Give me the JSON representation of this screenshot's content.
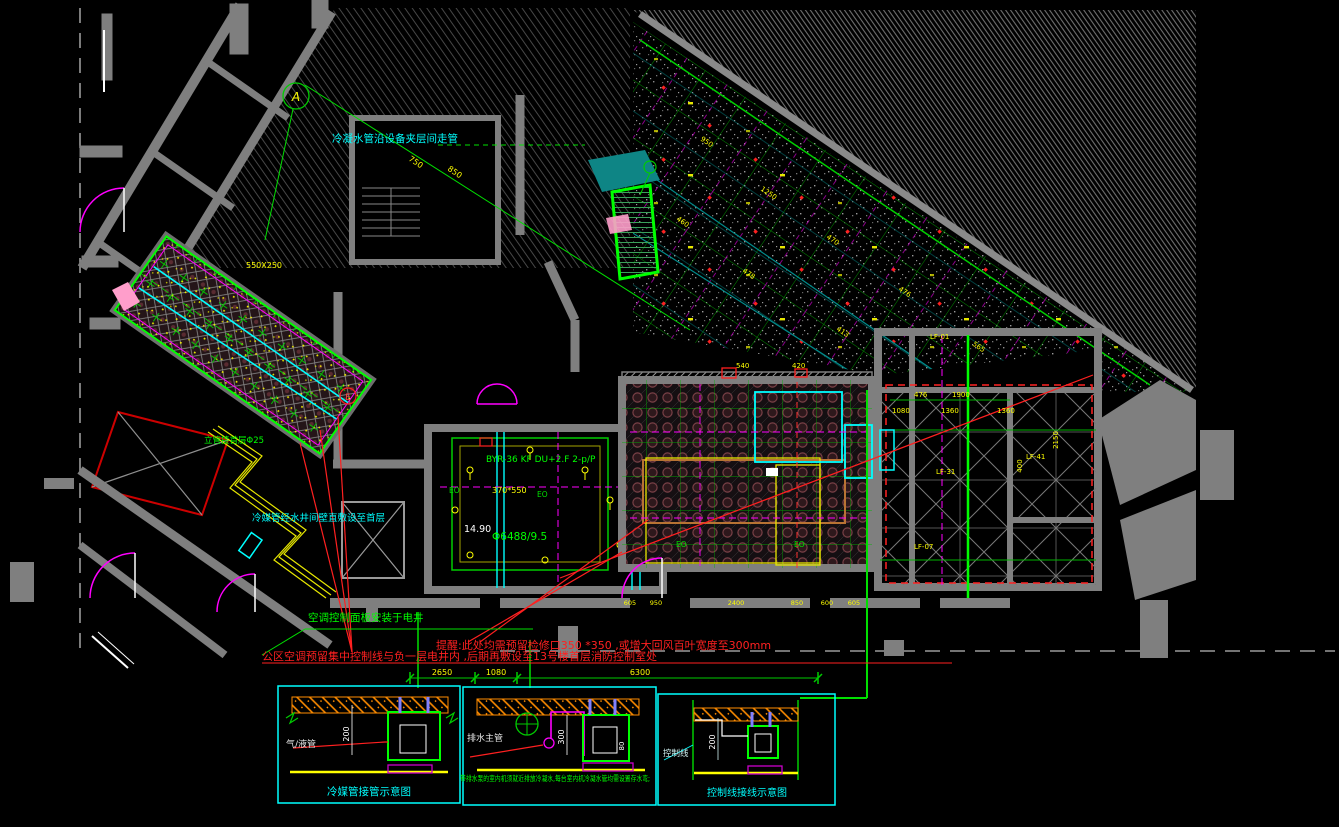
{
  "colors": {
    "background": "#000000",
    "wall_gray": "#7f7f7f",
    "bright_green": "#00ff00",
    "dim_green": "#00b400",
    "yellow": "#ffff00",
    "cyan": "#00ffff",
    "magenta": "#ff00ff",
    "red": "#ff0000",
    "orange": "#ff8c00",
    "teal_fill": "#0e8585",
    "maroon": "#5a2b31",
    "white": "#ffffff"
  },
  "annotations": {
    "condensate_route": "冷凝水管沿设备夹层间走管",
    "riser_note": "立管接首层Φ25",
    "refrigerant_shaft_note": "冷媒管经水井间壁直敷设至首层",
    "panel_note": "空调控制面板安装于电井",
    "warning_access": "提醒:此处均需预留检修口350 *350 ,或增大回风百叶宽度至300mm",
    "warning_control": "公区空调预留集中控制线与负一层电井内 ,后期再敷设至13号楼首层消防控制室处",
    "marker_a": "A",
    "marker_e": "E",
    "room_tag": "BYR-36 KF DU+2.F 2-p/P",
    "duct_size": "370*550",
    "level": "14.90",
    "pipe_spec": "Φ6488/9.5",
    "duct_tag": "550X250",
    "eo": "EO"
  },
  "dimensions": {
    "bottom": [
      "2650",
      "1080",
      "6300"
    ],
    "right": [
      "476",
      "1900",
      "1080",
      "1360",
      "1360",
      "400",
      "2150"
    ],
    "hall_top": [
      "540",
      "420"
    ],
    "hall_bottom": [
      "605",
      "950",
      "2400",
      "850",
      "600",
      "605"
    ],
    "diag": [
      "750",
      "850"
    ]
  },
  "tags": {
    "lf_1": "LF-01",
    "lf_2": "LF-31",
    "lf_3": "LF-41",
    "lf_4": "LF-07",
    "stipple": [
      "950",
      "1250",
      "470",
      "476",
      "565",
      "478",
      "413",
      "460"
    ]
  },
  "details": {
    "box1": {
      "title": "冷媒管接管示意图",
      "pipe_label": "气/液管",
      "dim": "200"
    },
    "box2": {
      "label": "排水主管",
      "dim_drop": "300",
      "dim_offset": "80",
      "note": "带排水泵的室内机须就近排放冷凝水,每台室内机冷凝水管均需设置存水弯;"
    },
    "box3": {
      "title": "控制线接线示意图",
      "label": "控制线",
      "dim": "200"
    }
  }
}
